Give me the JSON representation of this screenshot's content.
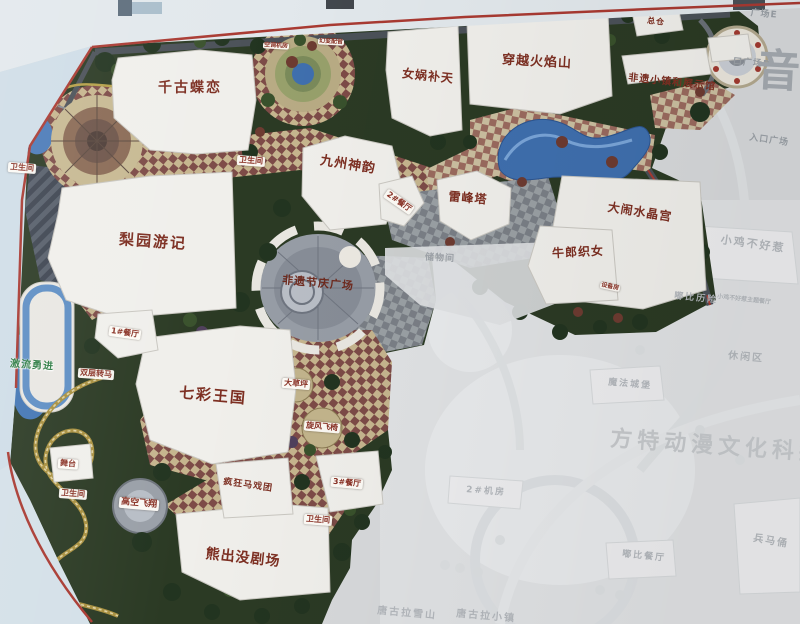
{
  "photo": {
    "description": "Photograph of a theme park master plan map on a display board"
  },
  "colors": {
    "map_green": "#2b3a24",
    "checker_tan": "#c9ba93",
    "checker_maroon": "#7d4b47",
    "plaza_gray": "#979da6",
    "water_blue": "#3f6fae",
    "border_red": "#a93a32",
    "coaster_gold": "#a8903f",
    "label_red": "#8a3226",
    "faded_gray": "#b3b7bc"
  },
  "labels": {
    "qiangu_dielian": "千古蝶恋",
    "nvwa_butian": "女娲补天",
    "chuanyue_huoyanshan": "穿越火焰山",
    "zongcang": "总仓",
    "guangchang_e": "广场E",
    "kou_guangchang_d": "口广场D",
    "rukou_guangchang": "入口广场",
    "feiyi_xiaozhen": "非遗小镇和展示馆",
    "jiuzhou_shenyun": "九州神韵",
    "leifengta": "雷峰塔",
    "danao_shuijinggong": "大闹水晶宫",
    "niulang_zhinv": "牛郎织女",
    "liyuan_youji": "梨园游记",
    "feiyi_jieqing_guangchang": "非遗节庆广场",
    "qicai_wangguo": "七彩王国",
    "xiongchumo_juchang": "熊出没剧场",
    "fengkuang_maxituan": "疯狂马戏团",
    "gaokong_feixiang": "高空飞翔",
    "wutai": "舞台",
    "jiliu_yongjin": "激流勇进",
    "shuangceng_zhuanma": "双层转马",
    "canting_1": "1#餐厅",
    "canting_2": "2#餐厅",
    "canting_3": "3#餐厅",
    "dacaoping": "大草坪",
    "xuanfeng_feiyi": "旋风飞椅",
    "weishengjian": "卫生间",
    "shebeifang": "设备房",
    "kongtiao_jifang": "空调机房",
    "huanbian_peiyin": "幻变配音",
    "chuwujian": "储物间",
    "faded": {
      "xiaoji": "小鸡不好惹",
      "xiaoji_canting": "小鸡不好惹主题餐厅",
      "dubi_lixian": "嘟比历险",
      "xiuxianqu": "休闲区",
      "mofa_chengbao": "魔法城堡",
      "bingmayong": "兵马俑",
      "dubi_canting": "嘟比餐厅",
      "jifang_2": "2#机房",
      "tanggula_xueshan": "唐古拉雪山",
      "tanggula_xiaozhen": "唐古拉小镇",
      "watermark": "方特动漫文化科技",
      "yin": "音"
    }
  }
}
